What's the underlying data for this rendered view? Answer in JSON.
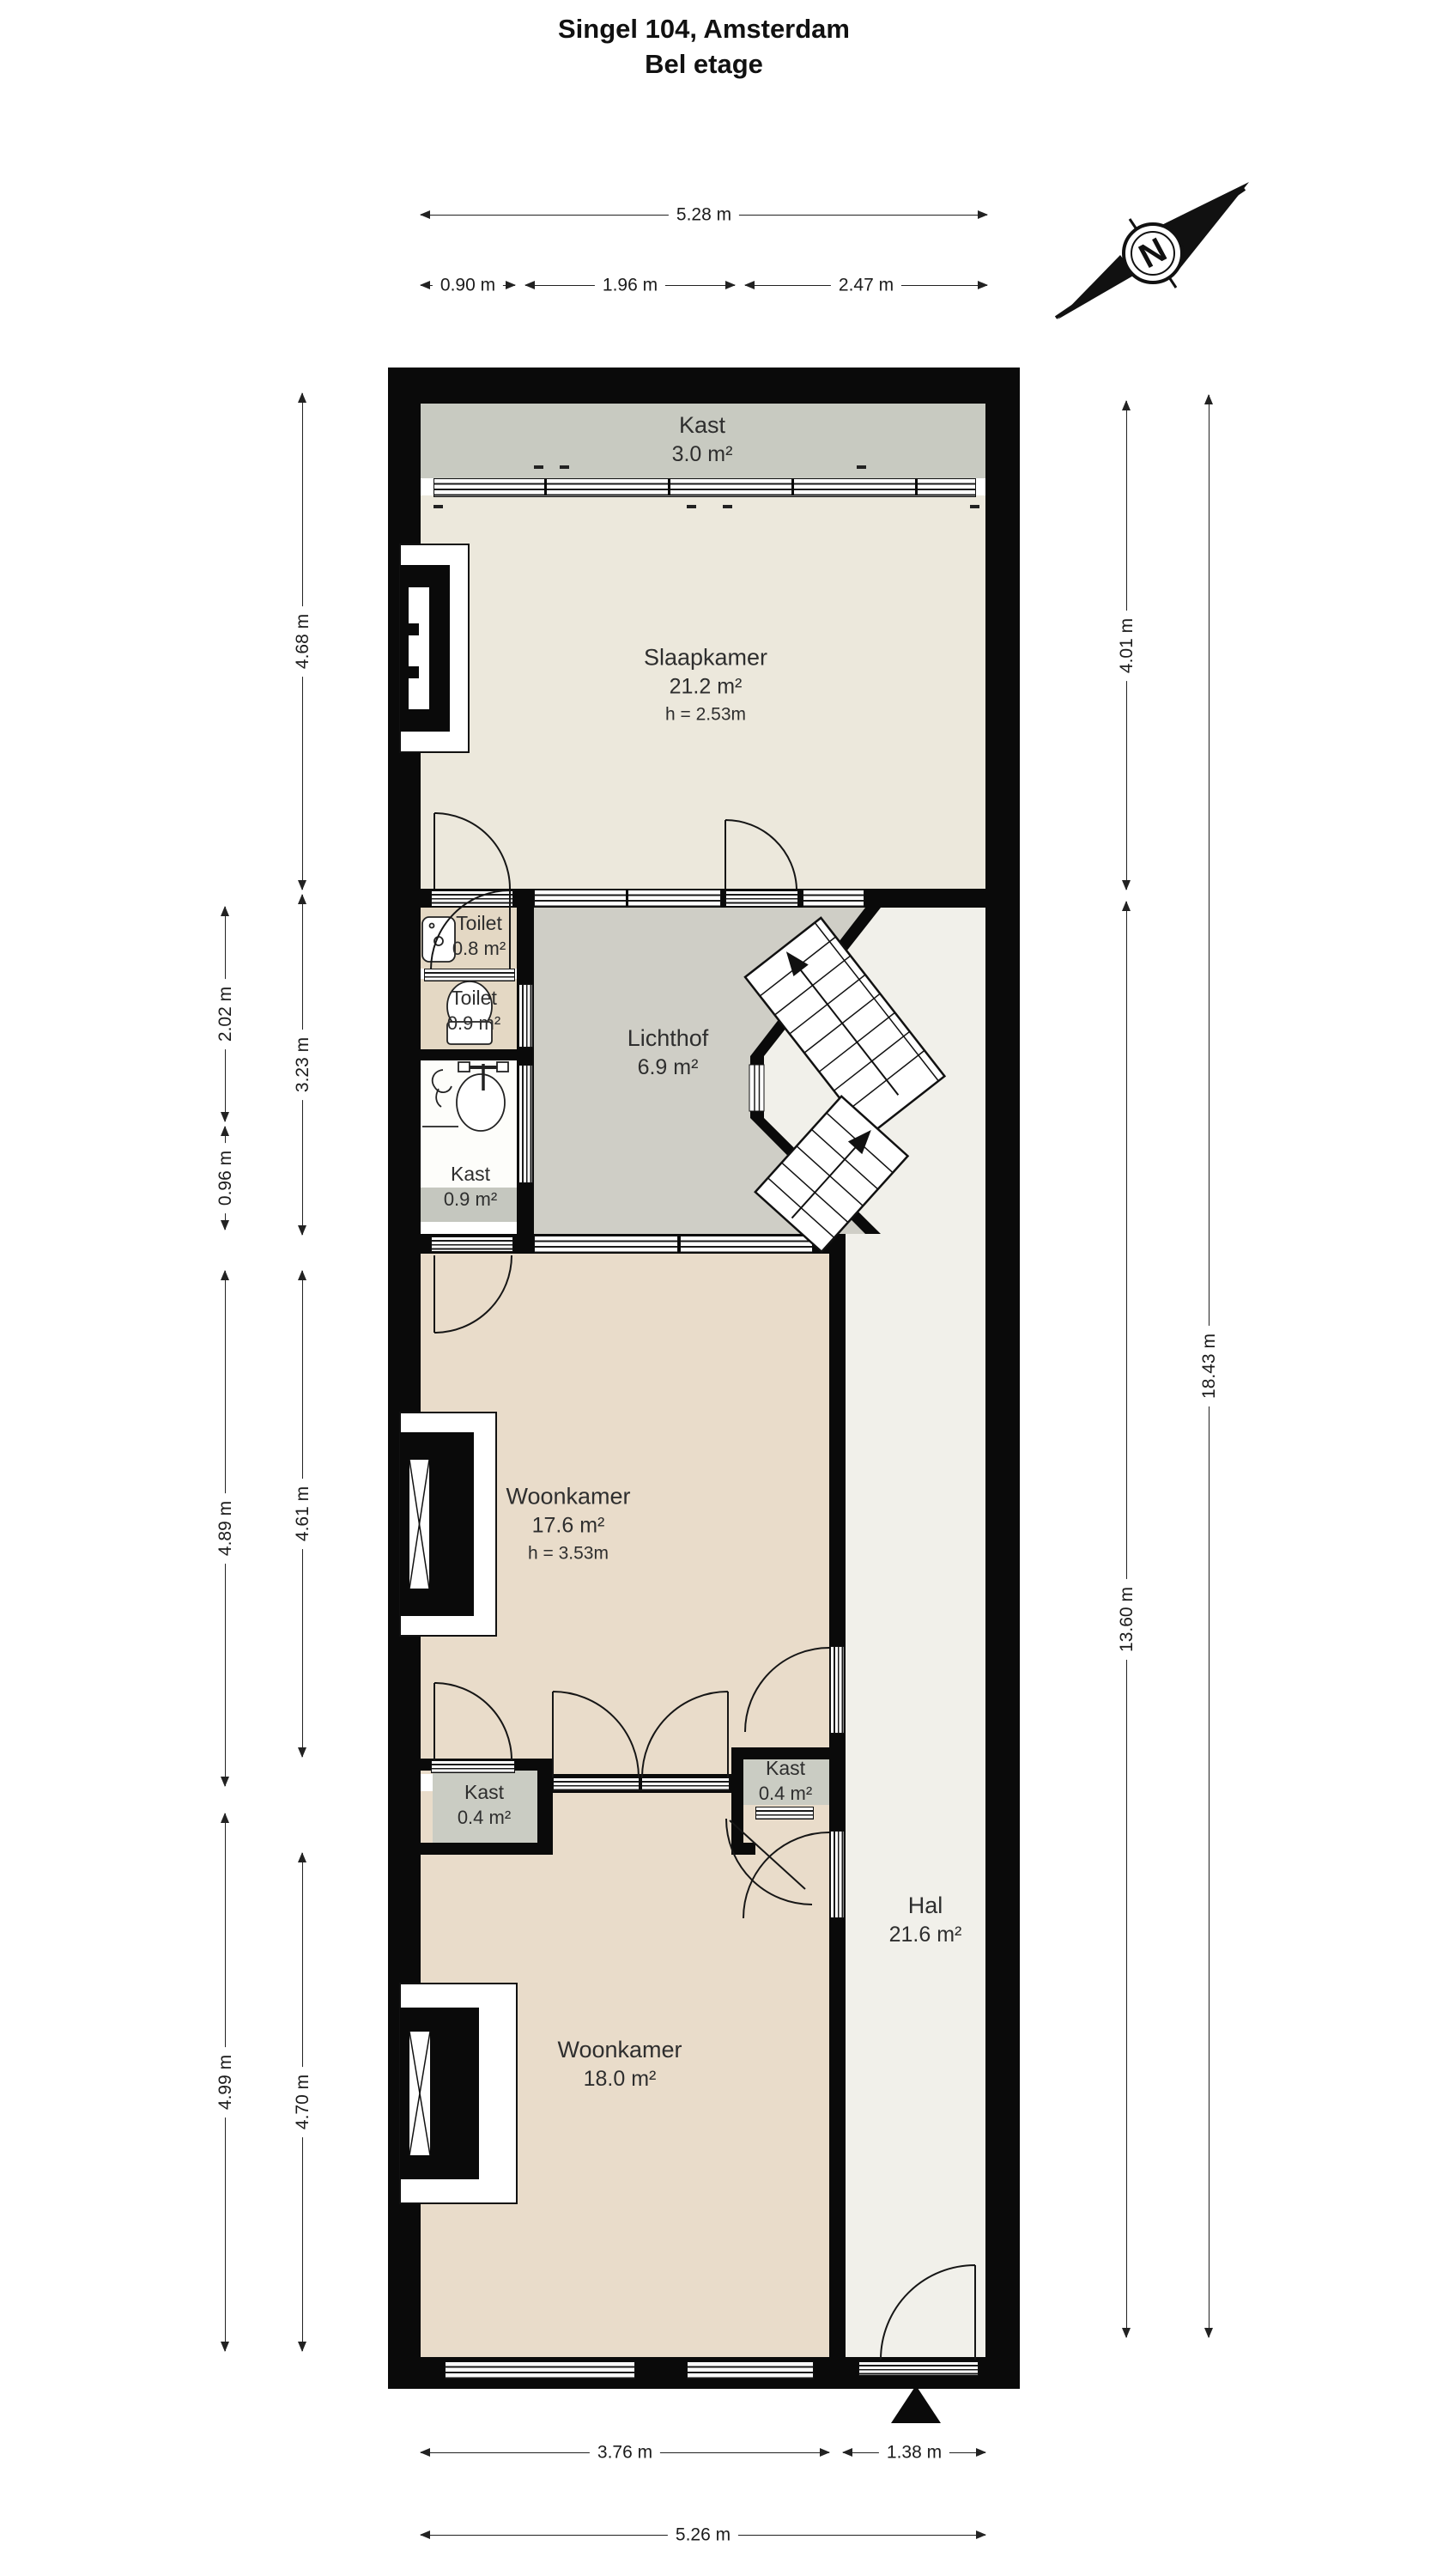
{
  "title": {
    "line1": "Singel 104, Amsterdam",
    "line2": "Bel etage"
  },
  "compass": {
    "north_label": "N"
  },
  "rooms": {
    "kast_top": {
      "name": "Kast",
      "area": "3.0 m²"
    },
    "slaapkamer": {
      "name": "Slaapkamer",
      "area": "21.2 m²",
      "ceiling": "h = 2.53m"
    },
    "toilet1": {
      "name": "Toilet",
      "area": "0.8 m²"
    },
    "toilet2": {
      "name": "Toilet",
      "area": "0.9 m²"
    },
    "kast_mid": {
      "name": "Kast",
      "area": "0.9 m²"
    },
    "lichthof": {
      "name": "Lichthof",
      "area": "6.9 m²"
    },
    "woonkamer1": {
      "name": "Woonkamer",
      "area": "17.6 m²",
      "ceiling": "h = 3.53m"
    },
    "kast_left": {
      "name": "Kast",
      "area": "0.4 m²"
    },
    "kast_right": {
      "name": "Kast",
      "area": "0.4 m²"
    },
    "woonkamer2": {
      "name": "Woonkamer",
      "area": "18.0 m²"
    },
    "hal": {
      "name": "Hal",
      "area": "21.6 m²"
    }
  },
  "dimensions": {
    "top_total": "5.28 m",
    "top_segments": [
      "0.90 m",
      "1.96 m",
      "2.47 m"
    ],
    "left_outer": [
      "2.02 m",
      "0.96 m",
      "4.89 m",
      "4.99 m"
    ],
    "left_inner": [
      "4.68 m",
      "3.23 m",
      "4.61 m",
      "4.70 m"
    ],
    "right_inner": [
      "4.01 m",
      "13.60 m"
    ],
    "right_outer": [
      "18.43 m"
    ],
    "bottom_segments": [
      "3.76 m",
      "1.38 m"
    ],
    "bottom_total": "5.26 m"
  },
  "colors": {
    "wall": "#0a0a0a",
    "slaapkamer_floor": "#ece8dc",
    "woonkamer_floor": "#e9dcca",
    "toilet_floor": "#e4d8c4",
    "lichthof_floor": "#cfcec6",
    "hal_floor": "#f1f0ea",
    "closet_floor": "#c8cac1"
  }
}
